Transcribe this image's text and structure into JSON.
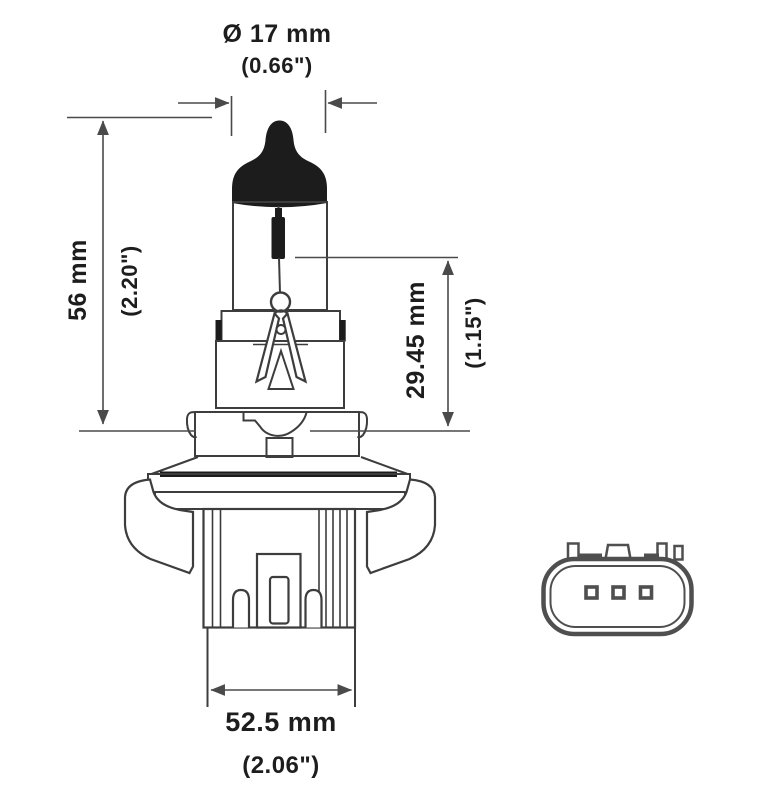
{
  "page": {
    "background": "#ffffff"
  },
  "drawing": {
    "type": "technical-diagram",
    "subject": "Halogen headlight bulb outline drawing with dimension callouts and connector socket face view",
    "line_color": "#3d3d3d",
    "black_fill_color": "#1c1c1c",
    "connector_line_color": "#4f4f4f",
    "text_color": "#1d1d1d"
  },
  "dimensions": {
    "diameter": {
      "mm": "Ø 17 mm",
      "inch": "(0.66\")"
    },
    "overall_length": {
      "mm": "56 mm",
      "inch": "(2.20\")"
    },
    "light_center_length": {
      "mm": "29.45 mm",
      "inch": "(1.15\")"
    },
    "base_width": {
      "mm": "52.5 mm",
      "inch": "(2.06\")"
    }
  }
}
